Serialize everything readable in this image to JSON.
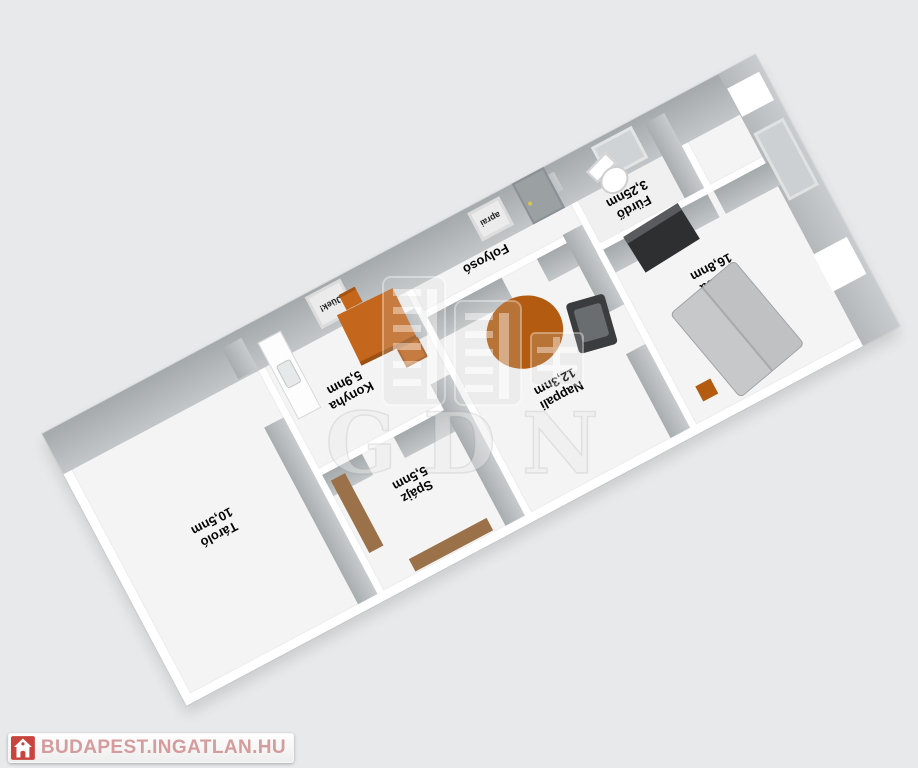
{
  "page": {
    "background": "#e8e9ea"
  },
  "rooms": [
    {
      "key": "tarolo",
      "name": "Tároló",
      "area": "10,5nm"
    },
    {
      "key": "konyha",
      "name": "Konyha",
      "area": "5,9nm"
    },
    {
      "key": "spajz",
      "name": "Spájz",
      "area": "5,5nm"
    },
    {
      "key": "folyoso",
      "name": "Folyosó",
      "area": "9,6nm"
    },
    {
      "key": "nappali",
      "name": "Nappali",
      "area": "12,3nm"
    },
    {
      "key": "szoba",
      "name": "Szoba",
      "area": "16,8nm"
    },
    {
      "key": "furdo",
      "name": "Fürdő",
      "area": "3,25nm"
    }
  ],
  "wall_decor": [
    {
      "text": "Jüek!"
    },
    {
      "text": "aprai"
    }
  ],
  "watermark": {
    "text": "GDN"
  },
  "logo": {
    "text": "BUDAPEST.INGATLAN.HU"
  },
  "colors": {
    "accent_orange": "#bf5f12",
    "rug_orange": "#b35b10",
    "wood_brown": "#9a7148",
    "wall_face_gray": "#aeb2b5",
    "logo_red": "#c8443c",
    "logo_text_pink": "#d49c9c"
  }
}
